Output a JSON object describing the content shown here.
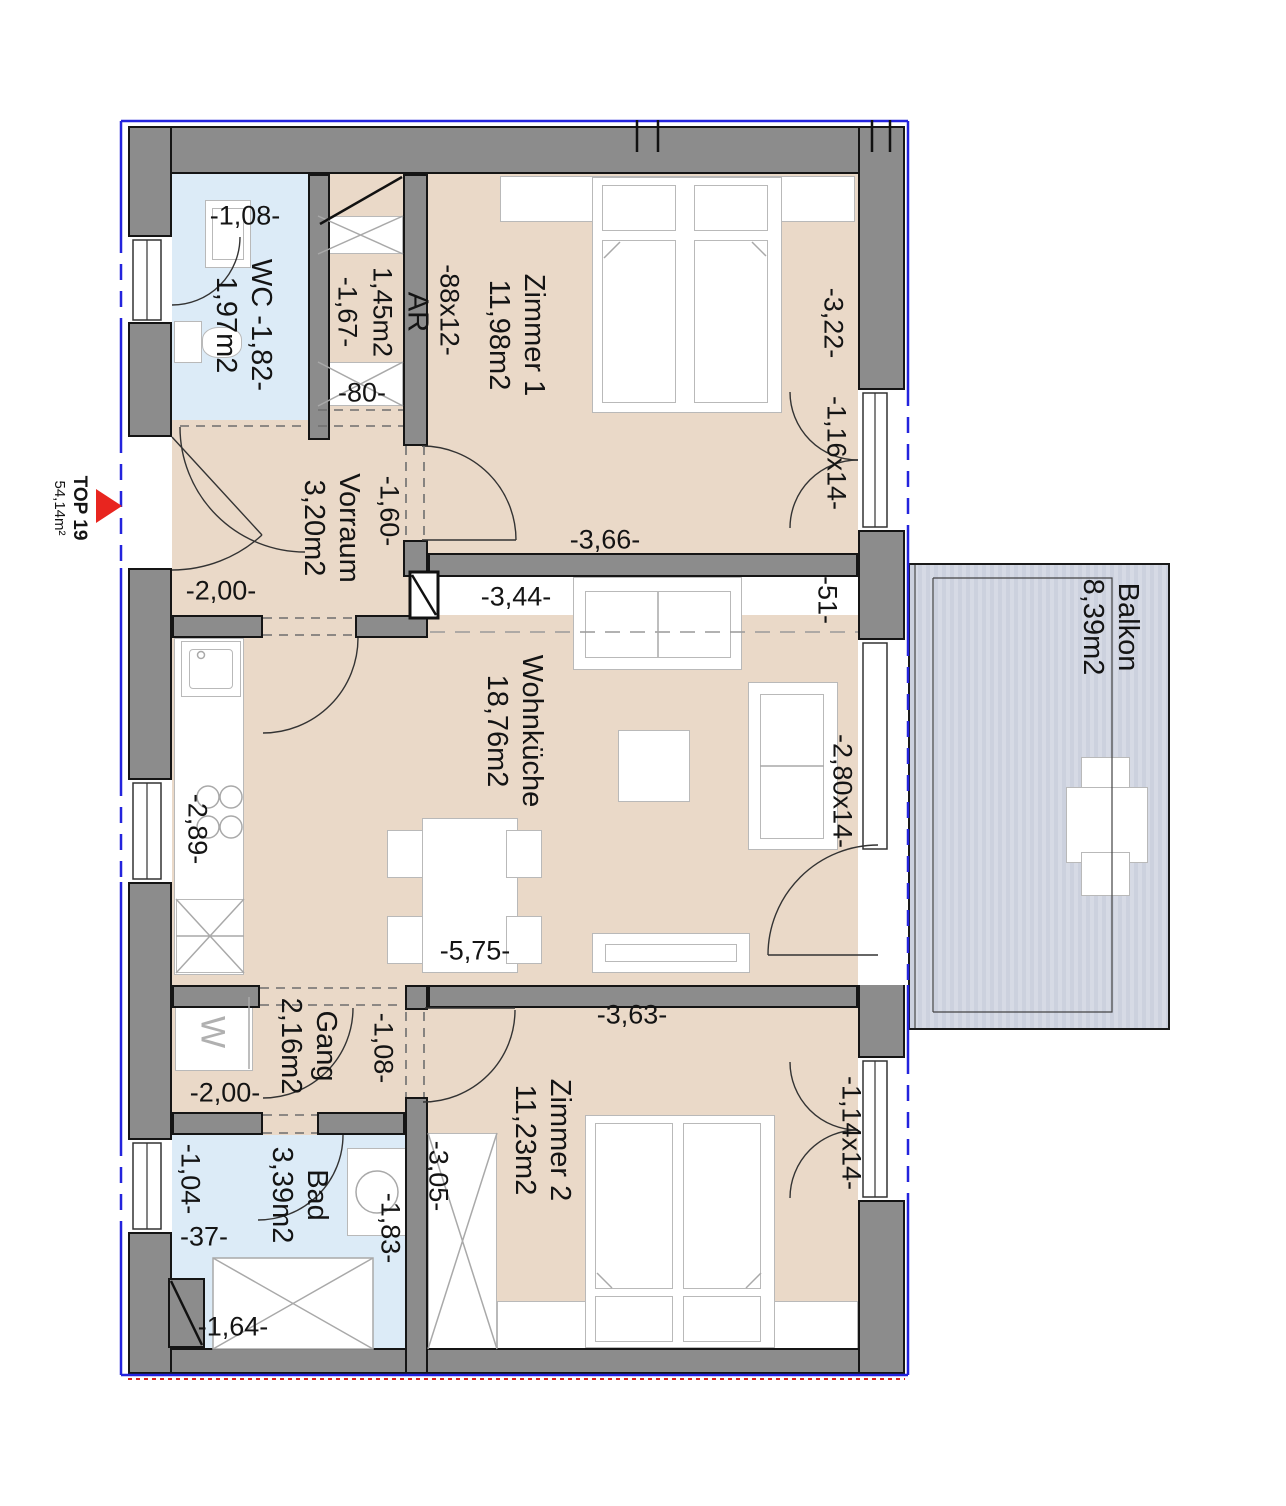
{
  "marker": {
    "unit": "TOP 19",
    "area": "54,14m²"
  },
  "rooms": {
    "wc": {
      "name": "WC -1,82-",
      "area": "1,97m2"
    },
    "ar": {
      "name": "AR",
      "area": "1,45m2",
      "dim": "-1,67-"
    },
    "zimmer1": {
      "name": "Zimmer 1",
      "area": "11,98m2"
    },
    "vorraum": {
      "name": "Vorraum",
      "area": "3,20m2"
    },
    "wohnkueche": {
      "name": "Wohnküche",
      "area": "18,76m2"
    },
    "gang": {
      "name": "Gang",
      "area": "2,16m2"
    },
    "bad": {
      "name": "Bad",
      "area": "3,39m2"
    },
    "zimmer2": {
      "name": "Zimmer 2",
      "area": "11,23m2"
    },
    "balkon": {
      "name": "Balkon",
      "area": "8,39m2"
    }
  },
  "appliances": {
    "washer": "W"
  },
  "dimensions": {
    "wc_width": "-1,08-",
    "ar_door": "-80-",
    "zimmer1_door": "-88x12-",
    "zimmer1_depth": "-3,22-",
    "zimmer1_window": "-1,16x14-",
    "zimmer1_width": "-3,66-",
    "vorraum_width": "-1,60-",
    "vorraum_entry": "-2,00-",
    "wohnkueche_top": "-3,44-",
    "pier": "-51-",
    "kitchen_run": "-2,89-",
    "balcony_door": "-2,80x14-",
    "wohnkueche_width": "-5,75-",
    "gang_width": "-2,00-",
    "gang_door": "-1,08-",
    "zimmer2_width": "-3,63-",
    "zimmer2_depth": "-3,05-",
    "zimmer2_window": "-1,14x14-",
    "bad_window": "-1,04-",
    "bad_nook": "-37-",
    "bad_depth": "-1,83-",
    "shower_width": "-1,64-"
  },
  "colors": {
    "floor_beige": "#ead9c8",
    "wet_room_blue": "#dcebf7",
    "wall_gray": "#8c8c8c",
    "balcony_gray": "#ccd1de",
    "boundary_blue": "#2323dd",
    "marker_red": "#e8251f"
  }
}
